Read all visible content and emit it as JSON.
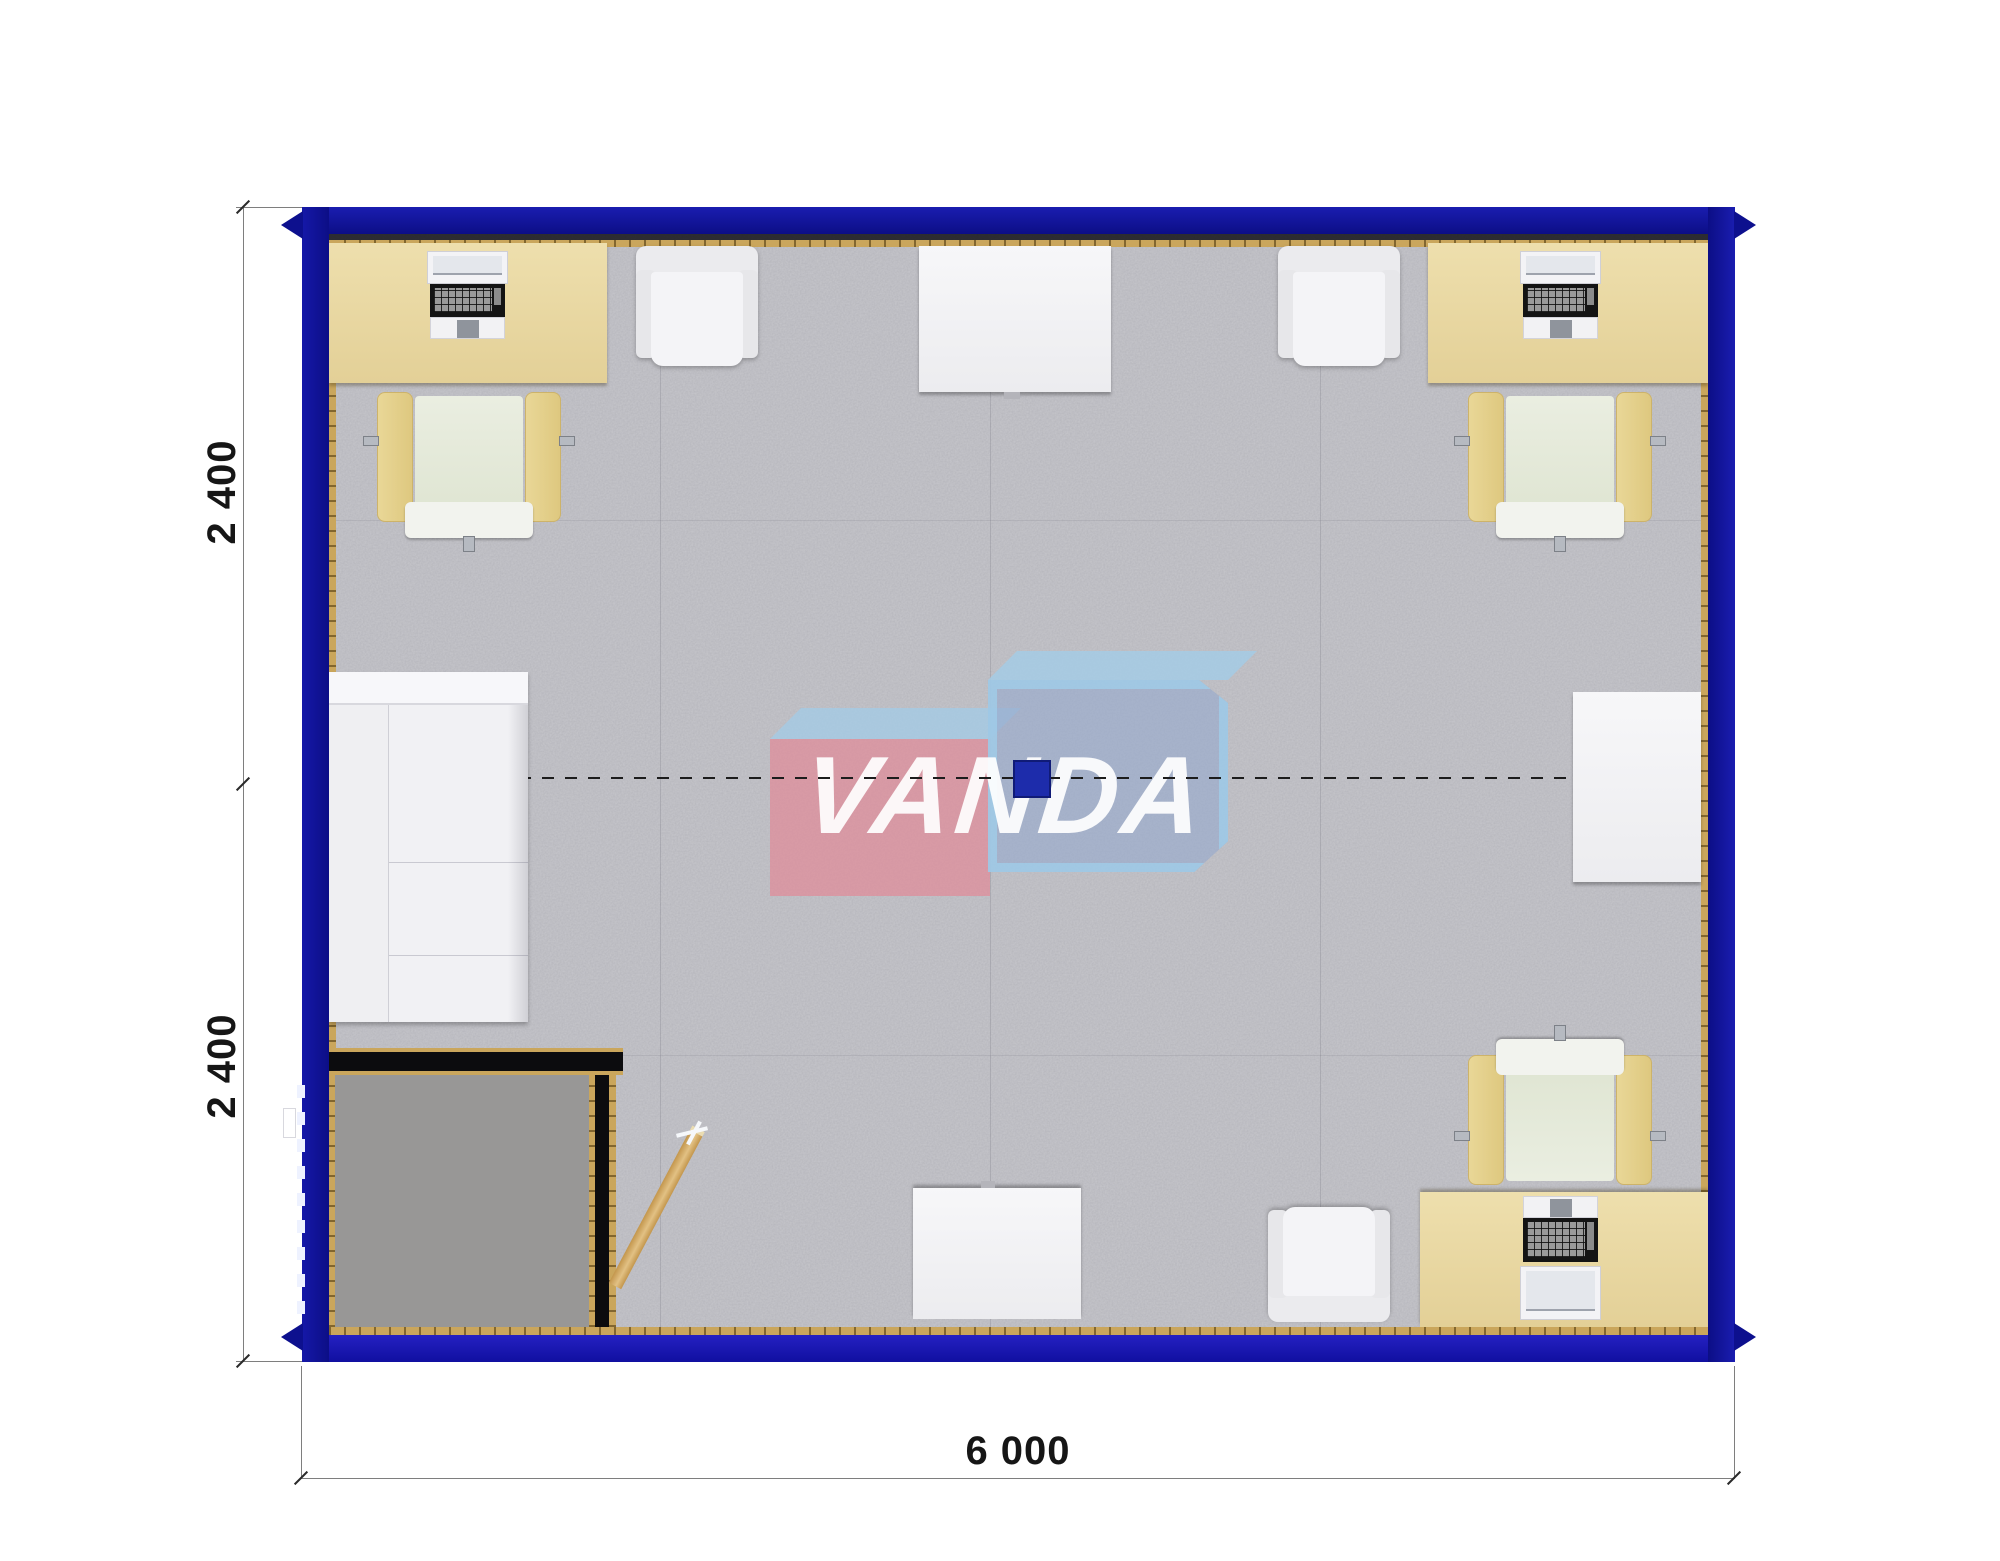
{
  "watermark": {
    "text": "VANDA"
  },
  "dimensions": {
    "left_top_label": "2 400",
    "left_bottom_label": "2 400",
    "bottom_label": "6 000"
  },
  "colors": {
    "wall_blue": "#0f118f",
    "trim_gold": "#caa65c",
    "desk_beige": "#e8d7a1",
    "carpet_main": "#c7c7cc",
    "carpet_vestibule": "#989796",
    "watermark_pink": "#e08b97",
    "watermark_blue": "#96aacd",
    "watermark_sky": "#a4cbe5",
    "column_blue": "#1d2cab",
    "door_wood": "#d2a55e"
  },
  "plan": {
    "type": "floor-plan-top-view",
    "module_count": 2,
    "furniture": [
      {
        "id": "desk-top-left",
        "type": "desk-with-computer"
      },
      {
        "id": "office-chair-top-left",
        "type": "office-chair"
      },
      {
        "id": "armchair-top-left",
        "type": "armchair"
      },
      {
        "id": "table-top-center",
        "type": "table"
      },
      {
        "id": "armchair-top-right",
        "type": "armchair"
      },
      {
        "id": "desk-top-right",
        "type": "desk-with-computer"
      },
      {
        "id": "office-chair-top-right",
        "type": "office-chair"
      },
      {
        "id": "sofa-left",
        "type": "sofa"
      },
      {
        "id": "table-right-middle",
        "type": "table"
      },
      {
        "id": "entry-vestibule",
        "type": "vestibule-with-open-door"
      },
      {
        "id": "table-bottom-center",
        "type": "table"
      },
      {
        "id": "armchair-bottom",
        "type": "armchair"
      },
      {
        "id": "desk-bottom-right",
        "type": "desk-with-computer"
      },
      {
        "id": "office-chair-bottom-right",
        "type": "office-chair"
      },
      {
        "id": "column-center",
        "type": "structural-column"
      }
    ]
  }
}
